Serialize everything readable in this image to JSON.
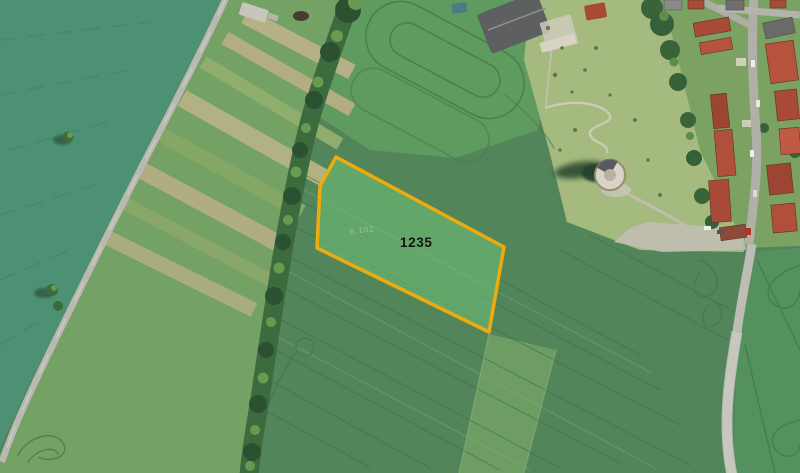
{
  "map": {
    "parcel": {
      "number": "1235",
      "faint_marking": "6.102",
      "outline_color": "#edab0e",
      "fill_color": "#74c87a",
      "label_color": "#141414"
    }
  }
}
